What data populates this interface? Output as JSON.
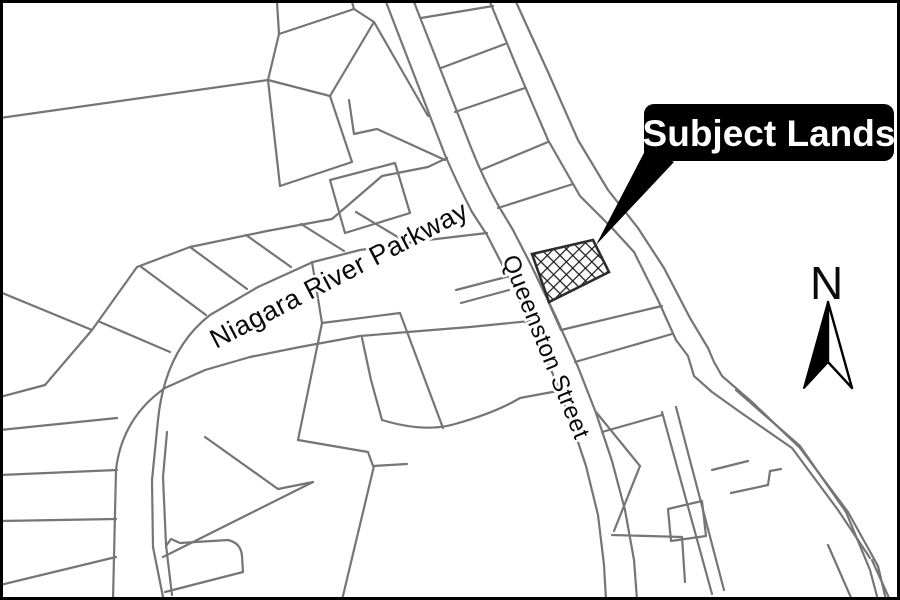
{
  "map": {
    "labels": {
      "parkway": {
        "text": "Niagara River Parkway",
        "transform": "translate(216,349) rotate(-27.5)"
      },
      "queenston": {
        "text": "Queenston Street",
        "transform": "translate(502,259) rotate(68)"
      },
      "callout": {
        "text": "Subject Lands"
      },
      "north": {
        "text": "N"
      }
    },
    "colors": {
      "background": "#ffffff",
      "parcel_line": "#757575",
      "hatch_line": "#1a1a1a",
      "callout_bg": "#000000",
      "callout_text": "#ffffff",
      "label_text": "#0a0a0a",
      "frame": "#000000"
    },
    "geometry": {
      "frame": {
        "x": 1.5,
        "y": 1.5,
        "w": 897,
        "h": 597
      },
      "parcel_paths": [
        "M0,118 L268,80",
        "M268,80 L279,34 L277,2",
        "M279,34 L354,9 L352,2",
        "M354,9 L374,22",
        "M374,22 L330,96",
        "M330,96 L268,80",
        "M374,22 L428,116",
        "M330,96 L352,162",
        "M352,162 L280,186",
        "M280,186 L268,80",
        "M349,100 L354,134 L377,129 L445,160",
        "M330,180 L395,163 L410,213 L345,233 Z",
        "M45,385 L92,330 L137,267 L190,247 L267,231 L332,219 L382,176 L428,167 L447,158",
        "M487,233 L428,240 L360,250 L313,262 L258,287 L210,315 Q165,350 158,420 L152,480 L153,547 L163,597",
        "M530,321 L470,327 L420,331 L360,336 L300,347 L250,357 L205,370 L165,388 Q122,418 116,470 L113,600",
        "M100,322 L170,352",
        "M140,266 L206,315",
        "M190,247 L247,289",
        "M246,235 L291,267",
        "M301,224 L344,251",
        "M356,212 L401,239",
        "M0,292 L92,330",
        "M0,397 L45,385",
        "M0,430 L117,418",
        "M0,475 L117,470",
        "M0,521 L116,519",
        "M0,585 L116,557",
        "M205,437 L278,489",
        "M278,489 L313,482",
        "M313,482 L163,557",
        "M167,432 L163,477 L166,545 L172,595",
        "M166,546 L171,539 L180,543 L228,540 Q241,543 242,556 L243,572 L165,592",
        "M312,262 L322,323 L298,440",
        "M322,323 L400,313",
        "M400,313 L443,428",
        "M456,290 L506,277",
        "M461,303 L509,290",
        "M382,420 Q425,433 455,424 Q495,413 520,398 L563,390",
        "M298,440 L368,452 L373,466 L407,464",
        "M374,466 L342,600",
        "M362,338 L371,380 L382,420",
        "M386,2 L445,155 Q458,185 472,212 L487,235 L505,270 L530,322 L552,372 L570,418 L586,466 L598,515 L604,565 L606,600",
        "M414,2 L472,150 Q484,180 498,205 L513,230 L531,265 L556,317 L578,367 L596,413 L612,461 L625,510 L634,560 L637,600",
        "M490,2 L518,70 L548,140 L580,196 L612,228 L634,252 L658,300 L676,340 L688,356 L694,376 L712,392 L740,412 L792,448 L838,510 L870,558",
        "M516,2 L548,72 L578,140 L608,190 L638,228 L664,268 L690,318 L708,348 L714,362 L722,376 L752,402 L800,448 L848,512 L878,566 L886,600",
        "M872,560 L890,600",
        "M736,390 L800,446 L846,512 L870,570 L878,600",
        "M828,545 L852,600",
        "M421,18 L493,6",
        "M441,68 L505,44",
        "M455,112 L525,88",
        "M481,170 L548,142",
        "M498,208 L573,184",
        "M548,301 L561,330",
        "M561,330 L662,306",
        "M575,362 L672,334",
        "M602,432 L662,415",
        "M662,412 L712,594",
        "M676,407 L724,590",
        "M596,412 L640,466",
        "M640,466 L614,531",
        "M612,535 L682,537",
        "M682,537 L685,582",
        "M668,509 L702,501 L706,536 L671,541 Z",
        "M712,470 L748,461",
        "M731,493 L768,485 L770,471 L781,469"
      ],
      "hatch_points": "532,254 593,240 609,272 549,302",
      "leader_points": "646,149 674,162 596,245",
      "callout_rect": {
        "x": 644,
        "y": 104,
        "w": 250,
        "h": 57,
        "rx": 10
      },
      "callout_text_pos": {
        "x": 769,
        "y": 146
      },
      "north_arrow": {
        "left_points": "828,302 828,362 804,388",
        "right_points": "828,302 852,388 828,362",
        "n_pos": {
          "x": 810,
          "y": 299
        }
      }
    }
  }
}
